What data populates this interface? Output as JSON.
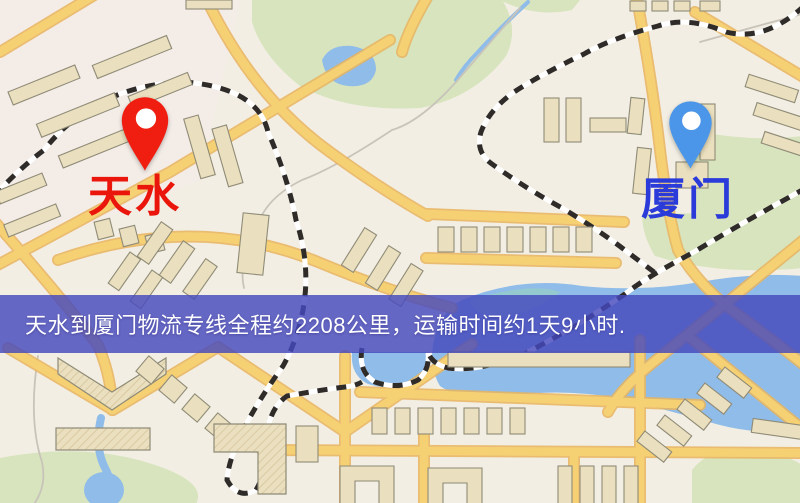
{
  "meta": {
    "kind": "logistics-route-map-image",
    "width_px": 800,
    "height_px": 503
  },
  "map": {
    "origin": {
      "label": "天水",
      "pin": "red-map-pin"
    },
    "destination": {
      "label": "厦门",
      "pin": "blue-map-pin"
    }
  },
  "banner": {
    "text": "天水到厦门物流专线全程约2208公里，运输时间约1天9小时."
  },
  "route_facts": {
    "distance_text": "约2208公里",
    "duration_text": "约1天9小时"
  },
  "palette": {
    "land": "#f2eee3",
    "district-tint": "#f7e9ea",
    "park": "#d7e4bd",
    "water": "#90bce9",
    "water-teal": "#96cfc6",
    "road": "#f6d174",
    "road-casing": "#e9b45e",
    "building": "#eadfbe",
    "building-stroke": "#8f8b77",
    "rail": "#2e2b28",
    "rail-base": "#ffffff",
    "contour": "#c9c4ba",
    "banner-bg": "#4549bd",
    "banner-text": "#ffffff",
    "pin-red": "#f01e10",
    "pin-blue": "#4b96e8",
    "label-origin": "#ea150b",
    "label-dest": "#2a3bd9"
  }
}
